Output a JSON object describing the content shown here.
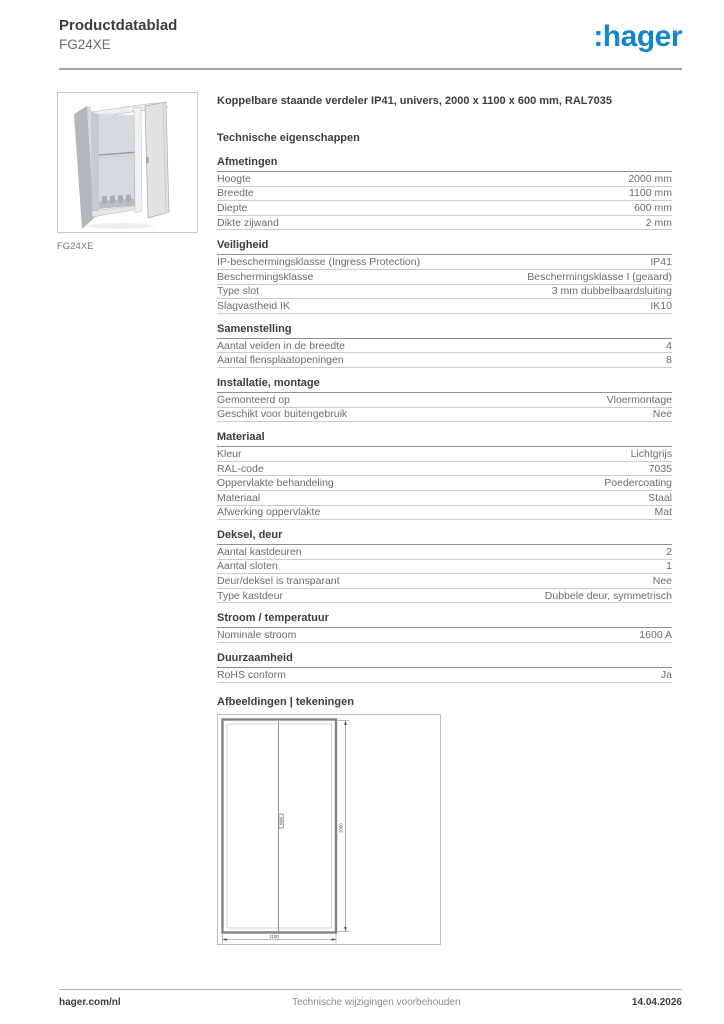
{
  "header": {
    "doc_type": "Productdatablad",
    "product_code": "FG24XE",
    "logo_text": ":hager"
  },
  "product_figure": {
    "caption": "FG24XE",
    "photo": "cabinet-with-open-doors"
  },
  "main": {
    "title": "Koppelbare staande verdeler IP41, univers, 2000 x 1100 x 600 mm, RAL7035",
    "tech_heading": "Technische eigenschappen"
  },
  "specs": {
    "sections": [
      {
        "title": "Afmetingen",
        "rows": [
          {
            "label": "Hoogte",
            "value": "2000 mm"
          },
          {
            "label": "Breedte",
            "value": "1100 mm"
          },
          {
            "label": "Diepte",
            "value": "600 mm"
          },
          {
            "label": "Dikte zijwand",
            "value": "2 mm"
          }
        ]
      },
      {
        "title": "Veiligheid",
        "rows": [
          {
            "label": "IP-beschermingsklasse (Ingress Protection)",
            "value": "IP41"
          },
          {
            "label": "Beschermingsklasse",
            "value": "Beschermingsklasse I (geaard)"
          },
          {
            "label": "Type slot",
            "value": "3 mm dubbelbaardsluiting"
          },
          {
            "label": "Slagvastheid IK",
            "value": "IK10"
          }
        ]
      },
      {
        "title": "Samenstelling",
        "rows": [
          {
            "label": "Aantal velden in de breedte",
            "value": "4"
          },
          {
            "label": "Aantal flensplaatopeningen",
            "value": "8"
          }
        ]
      },
      {
        "title": "Installatie, montage",
        "rows": [
          {
            "label": "Gemonteerd op",
            "value": "Vloermontage"
          },
          {
            "label": "Geschikt voor buitengebruik",
            "value": "Nee"
          }
        ]
      },
      {
        "title": "Materiaal",
        "rows": [
          {
            "label": "Kleur",
            "value": "Lichtgrijs"
          },
          {
            "label": "RAL-code",
            "value": "7035"
          },
          {
            "label": "Oppervlakte behandeling",
            "value": "Poedercoating"
          },
          {
            "label": "Materiaal",
            "value": "Staal"
          },
          {
            "label": "Afwerking oppervlakte",
            "value": "Mat"
          }
        ]
      },
      {
        "title": "Deksel, deur",
        "rows": [
          {
            "label": "Aantal kastdeuren",
            "value": "2"
          },
          {
            "label": "Aantal sloten",
            "value": "1"
          },
          {
            "label": "Deur/deksel is transparant",
            "value": "Nee"
          },
          {
            "label": "Type kastdeur",
            "value": "Dubbele deur, symmetrisch"
          }
        ]
      },
      {
        "title": "Stroom / temperatuur",
        "rows": [
          {
            "label": "Nominale stroom",
            "value": "1600 A"
          }
        ]
      },
      {
        "title": "Duurzaamheid",
        "rows": [
          {
            "label": "RoHS conform",
            "value": "Ja"
          }
        ]
      }
    ]
  },
  "drawings": {
    "heading": "Afbeeldingen | tekeningen",
    "height_label": "2000",
    "width_label": "1100"
  },
  "footer": {
    "website": "hager.com/nl",
    "notice": "Technische wijzigingen voorbehouden",
    "date": "14.04.2026"
  },
  "colors": {
    "brand_blue": "#1487c9",
    "heading_text": "#3d3d3d",
    "body_text": "#6b6b6b",
    "section_rule": "#8f8f8f",
    "row_rule": "#cbcbcb"
  }
}
